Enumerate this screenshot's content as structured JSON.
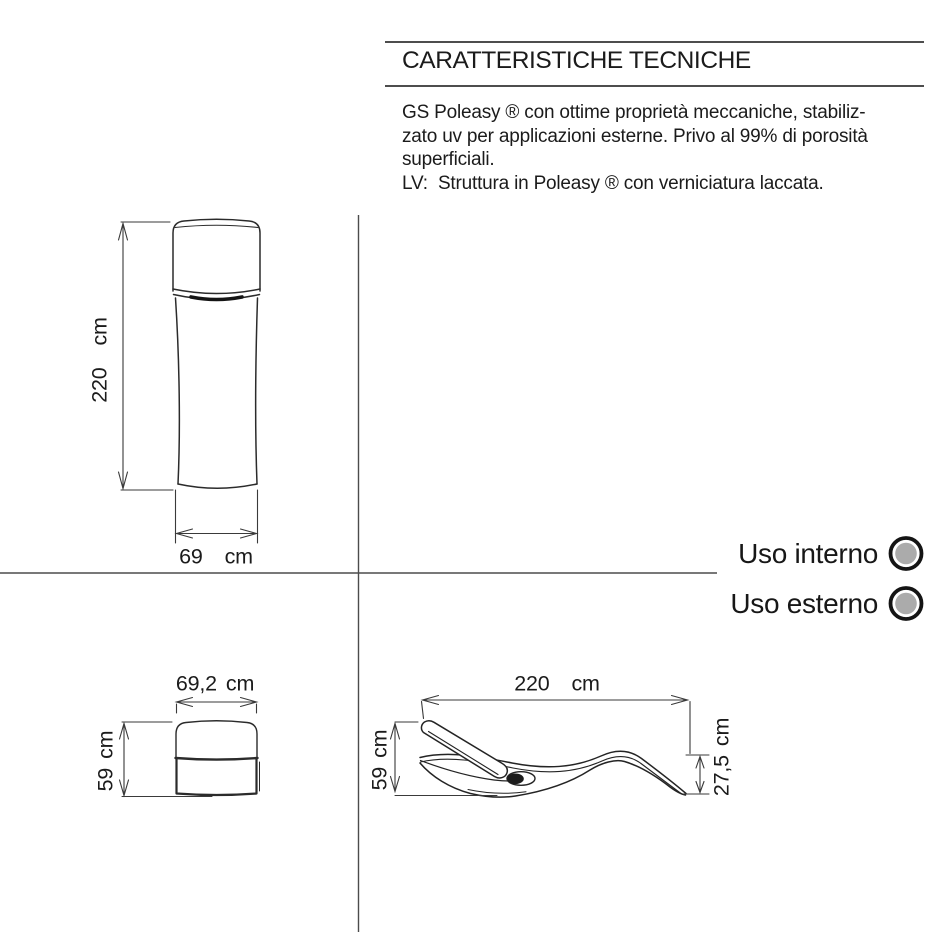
{
  "tech_specs": {
    "title": "CARATTERISTICHE TECNICHE",
    "description_lines": [
      "GS Poleasy ® con ottime proprietà meccaniche, stabiliz-",
      "zato uv per applicazioni esterne. Privo al 99% di porosità",
      "superficiali.",
      "LV:  Struttura in Poleasy ® con verniciatura laccata."
    ]
  },
  "usage": {
    "items": [
      {
        "label": "Uso interno"
      },
      {
        "label": "Uso esterno"
      }
    ],
    "indicator_fill": "#ababab",
    "indicator_ring": "#141414"
  },
  "dimensions": {
    "front_height": {
      "value": "220",
      "unit": "cm"
    },
    "front_width": {
      "value": "69",
      "unit": "cm"
    },
    "back_width": {
      "value": "69,2",
      "unit": "cm"
    },
    "back_height": {
      "value": "59",
      "unit": "cm"
    },
    "side_length": {
      "value": "220",
      "unit": "cm"
    },
    "side_height": {
      "value": "59",
      "unit": "cm"
    },
    "side_foot_height": {
      "value": "27,5",
      "unit": "cm"
    }
  },
  "colors": {
    "background": "#ffffff",
    "line": "#2b2b2b",
    "text": "#1b1b1b",
    "divider": "#4c4c4c"
  }
}
